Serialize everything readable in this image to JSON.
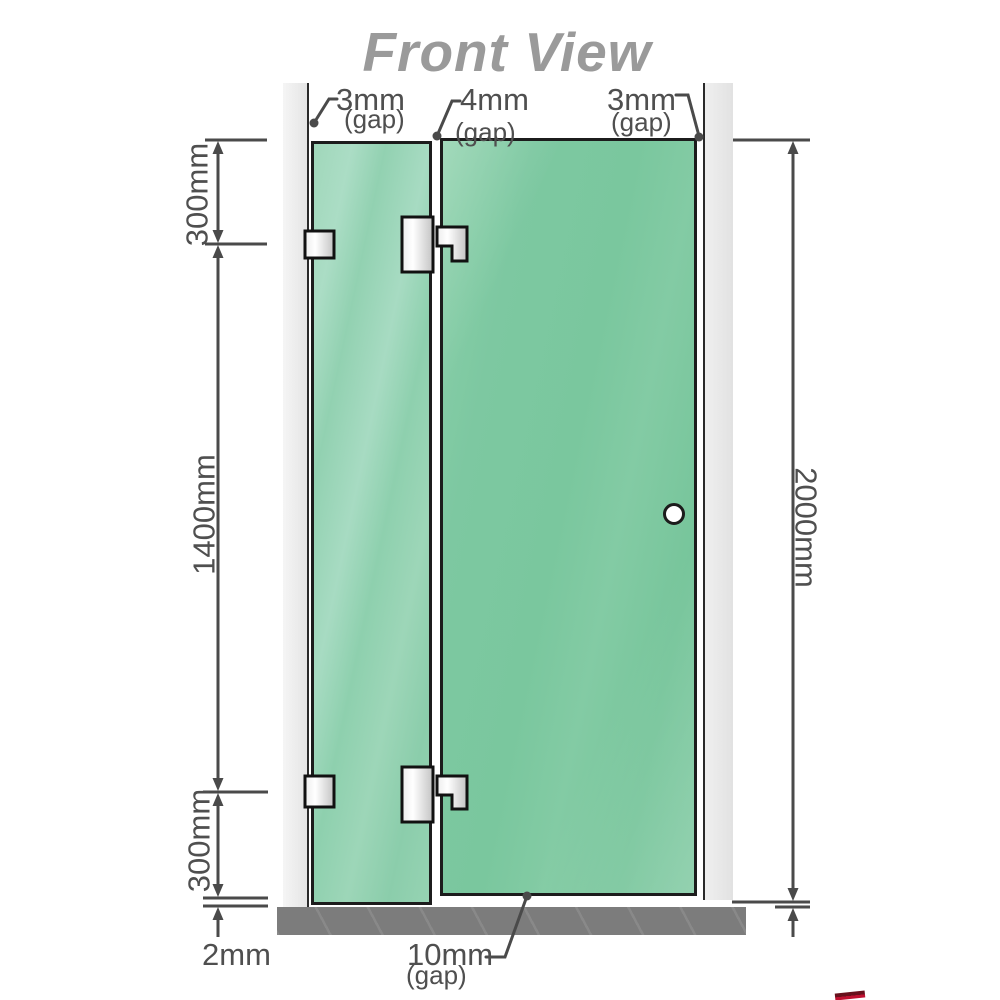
{
  "title": "Front View",
  "dimensions": {
    "gap_top_left": {
      "value": "3mm",
      "label": "(gap)"
    },
    "gap_top_middle": {
      "value": "4mm",
      "label": "(gap)"
    },
    "gap_top_right": {
      "value": "3mm",
      "label": "(gap)"
    },
    "gap_bottom_middle": {
      "value": "10mm",
      "label": "(gap)"
    },
    "left_top": "300mm",
    "left_middle": "1400mm",
    "left_bottom": "300mm",
    "right_full_height": "2000mm",
    "bottom_floor_gap": "2mm"
  },
  "colors": {
    "glass_green": "#7cc8a1",
    "glass_green_light": "#9dd6b8",
    "wall_gray": "#ececec",
    "floor_gray": "#7c7c7c",
    "dimension_line_gray": "#4a4a4a",
    "title_gray": "#9a9a9a",
    "hardware_metal": "#e8e8e8",
    "outline_black": "#1c1c1c"
  }
}
